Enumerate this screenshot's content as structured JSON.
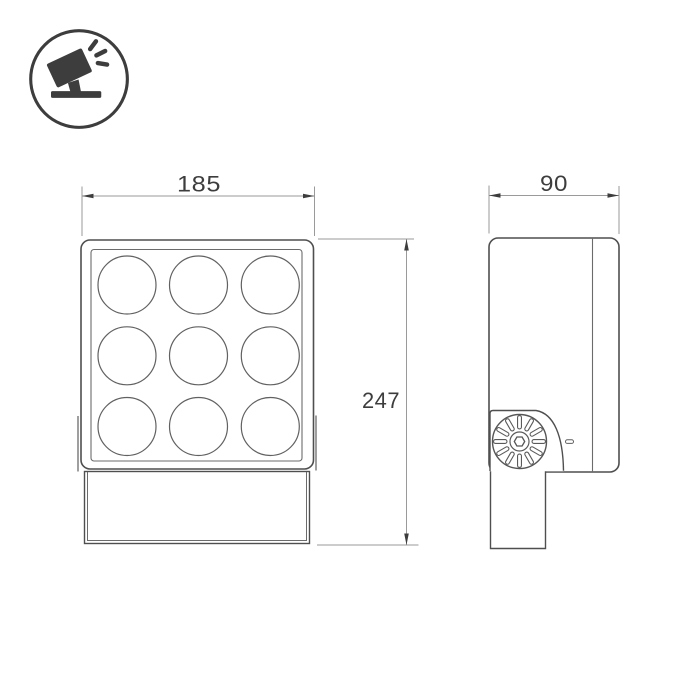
{
  "page": {
    "title": "Floodlight dimensional drawing",
    "background_color": "#ffffff"
  },
  "logo": {
    "icon": "tilted-floodlight-icon",
    "color": "#3d3d3d"
  },
  "drawing": {
    "type": "technical-dimension-drawing",
    "views": {
      "front": {
        "label": "front view",
        "lens_rows": 3,
        "lens_cols": 3,
        "lens_count": 9
      },
      "side": {
        "label": "side view",
        "features": [
          "hinge-knob",
          "mounting-arm",
          "indicator-dash",
          "back-panel-line"
        ]
      }
    },
    "dimensions": {
      "width": "185",
      "height": "247",
      "depth": "90"
    },
    "colors": {
      "object_line": "#4f4f4f",
      "thin_line": "#6b6b6b",
      "dim_line": "#9a9a9a",
      "arrow_and_text": "#3d3d3d",
      "fill": "#ffffff"
    }
  }
}
